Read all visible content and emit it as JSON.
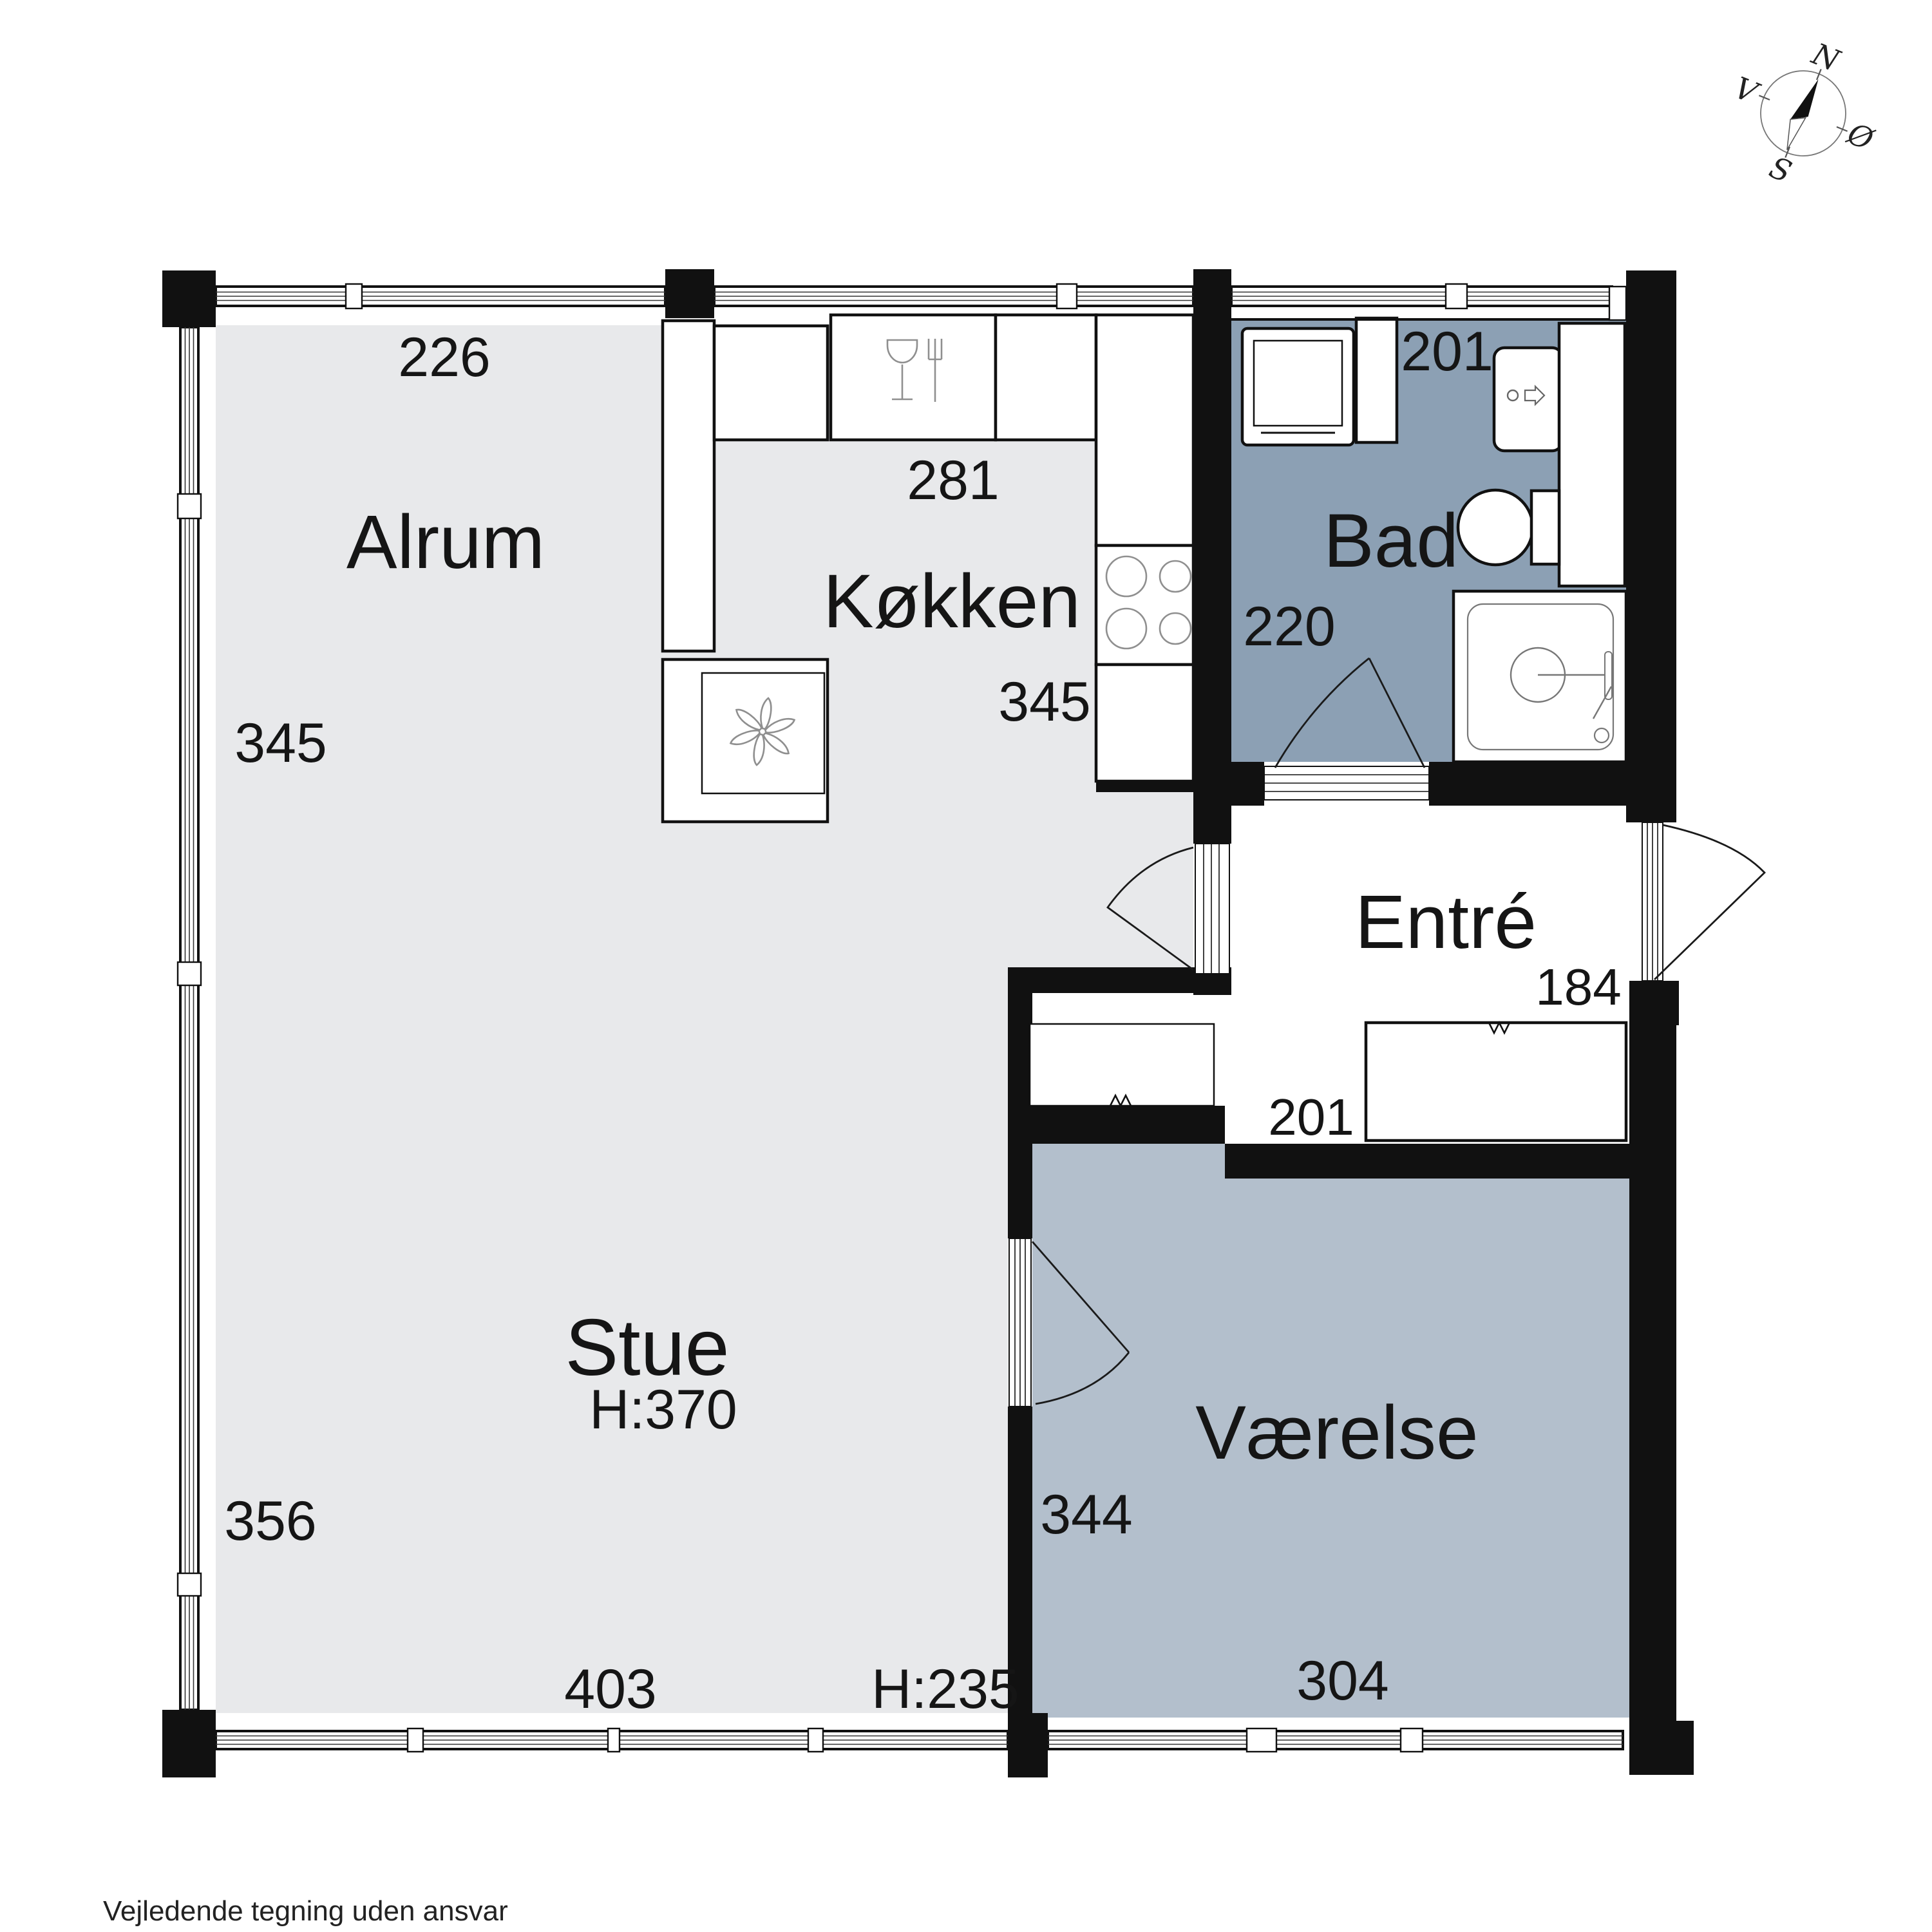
{
  "footer": {
    "disclaimer": "Vejledende tegning uden ansvar"
  },
  "compass": {
    "north": "N",
    "east": "Ø",
    "south": "S",
    "west": "V"
  },
  "colors": {
    "wall": "#111111",
    "floor_main": "#e8e9eb",
    "floor_bad": "#8ca0b4",
    "floor_vaerelse": "#b3bfcc",
    "fixture_outline": "#111111",
    "icon_stroke": "#8f8f8f"
  },
  "rooms": {
    "alrum": {
      "name": "Alrum",
      "dim_top": "226",
      "dim_left": "345"
    },
    "koekken": {
      "name": "Køkken",
      "dim_top": "281",
      "dim_below": "345"
    },
    "bad": {
      "name": "Bad",
      "dim_top": "201",
      "dim_left": "220"
    },
    "entre": {
      "name": "Entré",
      "dim_right": "184",
      "dim_bottom": "201"
    },
    "stue": {
      "name": "Stue",
      "ceiling_height": "H:370",
      "dim_left": "356",
      "dim_bottom": "403",
      "ceiling_height_low": "H:235"
    },
    "vaerelse": {
      "name": "Værelse",
      "dim_left": "344",
      "dim_bottom": "304"
    }
  },
  "icons": {
    "compass": "compass-rose",
    "kitchen": [
      "dishwasher-icon",
      "stove-burners-icon",
      "extractor-fan-icon"
    ],
    "bath": [
      "washing-machine-icon",
      "sink-icon",
      "toilet-icon",
      "shower-icon"
    ]
  }
}
